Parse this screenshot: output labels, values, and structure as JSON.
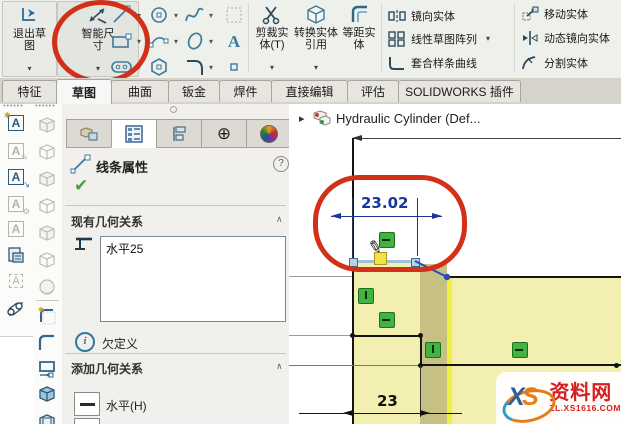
{
  "ribbon": {
    "exit_sketch_label": "退出草图",
    "smart_dim_label": "智能尺寸",
    "trim_label": "剪裁实体(T)",
    "convert_label": "转换实体引用",
    "offset_label": "等距实体",
    "mirror_label": "镜向实体",
    "pattern_label": "线性草图阵列",
    "fit_spline_label": "套合样条曲线",
    "move_label": "移动实体",
    "dyn_mirror_label": "动态镜向实体",
    "split_label": "分割实体",
    "caret": "▾"
  },
  "tabs": {
    "features": "特征",
    "sketch": "草图",
    "surfaces": "曲面",
    "sheet_metal": "钣金",
    "weldments": "焊件",
    "direct_edit": "直接编辑",
    "evaluate": "评估",
    "addins": "SOLIDWORKS 插件"
  },
  "panel": {
    "title": "线条属性",
    "help": "?",
    "check": "✔",
    "existing_relations_header": "现有几何关系",
    "relation_item": "水平25",
    "status": "欠定义",
    "status_i": "i",
    "add_relations_header": "添加几何关系",
    "horizontal_label": "水平(H)",
    "collapse_chevron": "∧",
    "dimxpert_glyph": "⊕"
  },
  "viewport": {
    "tree_item": "Hydraulic Cylinder  (Def...",
    "tree_expand": "▸",
    "dim_selected": "23.02",
    "dim_bottom": "23"
  },
  "watermark": {
    "logo_x": "X",
    "logo_s": "S",
    "name": "资料网",
    "url": "ZL.XS1616.COM"
  },
  "colors": {
    "icon_blue": "#3e7a99",
    "dimension_blue": "#1a35a0",
    "annotation_red": "#d23018",
    "relation_green": "#42b342",
    "sketch_fill_yellow": "#f3efb0"
  }
}
